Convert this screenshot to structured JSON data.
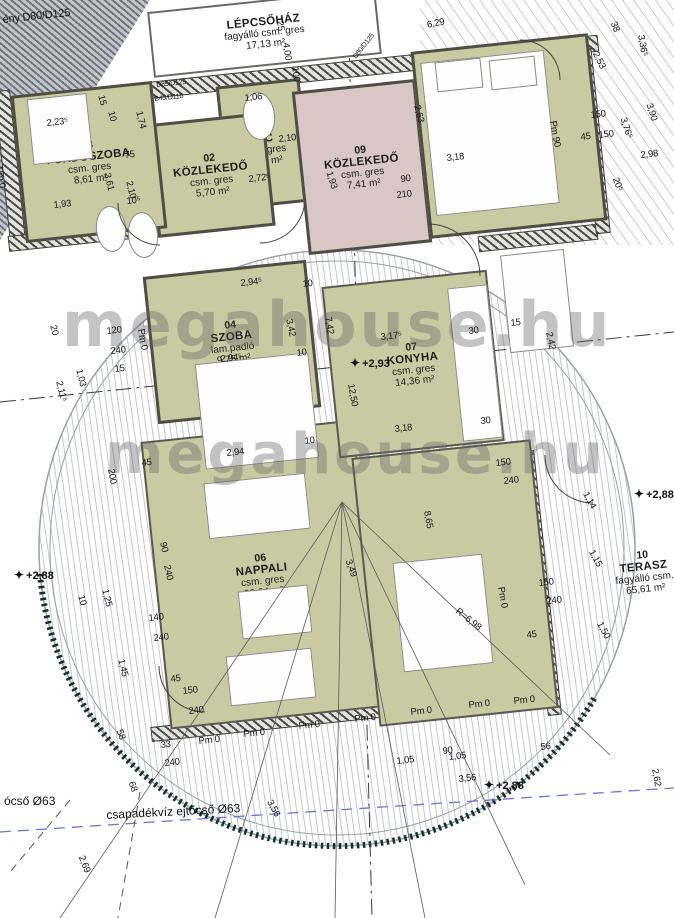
{
  "drawing": {
    "kind": "floor-plan"
  },
  "watermark": {
    "text": "megahouse.hu"
  },
  "rooms": [
    {
      "id": "lepcsohaz",
      "number": "",
      "name": "LÉPCSŐHÁZ",
      "material": "fagyálló csm. gres",
      "area": "17,13 m²",
      "x": 150,
      "y": 0,
      "w": 225,
      "h": 62,
      "fill": "#ffffff",
      "rot": -6,
      "wall": "thin"
    },
    {
      "id": "wc",
      "number": "01",
      "name": "WC",
      "material": "csm. gres",
      "area": "1,75 m²",
      "x": 222,
      "y": 82,
      "w": 78,
      "h": 118,
      "fill": "#c9caa2",
      "rot": -6,
      "wall": "solid"
    },
    {
      "id": "kozlekedo-02",
      "number": "02",
      "name": "KÖZLEKEDŐ",
      "material": "csm. gres",
      "area": "5,70 m²",
      "x": 152,
      "y": 118,
      "w": 112,
      "h": 108,
      "fill": "#c9caa2",
      "rot": -6,
      "wall": "solid"
    },
    {
      "id": "furdoszoba-03",
      "number": "03",
      "name": "FÜRDŐSZOBA",
      "material": "csm. gres",
      "area": "8,61 m²",
      "x": 18,
      "y": 88,
      "w": 136,
      "h": 142,
      "fill": "#c9caa2",
      "rot": -6,
      "wall": "solid"
    },
    {
      "id": "szoba-04",
      "number": "04",
      "name": "SZOBA",
      "material": "lam.padló",
      "area": "9,75 m²",
      "x": 150,
      "y": 268,
      "w": 158,
      "h": 142,
      "fill": "#c9caa2",
      "rot": -6,
      "wall": "solid"
    },
    {
      "id": "kozlekedo-09",
      "number": "09",
      "name": "KÖZLEKEDŐ",
      "material": "csm. gres",
      "area": "7,41 m²",
      "x": 300,
      "y": 85,
      "w": 118,
      "h": 158,
      "fill": "#d8c7c5",
      "rot": -6,
      "wall": "solid"
    },
    {
      "id": "nappali-06",
      "number": "06",
      "name": "NAPPALI",
      "material": "csm. gres",
      "area": "20,24 m²",
      "x": 155,
      "y": 430,
      "w": 210,
      "h": 285,
      "fill": "#c9caa2",
      "rot": -6,
      "wall": "open"
    },
    {
      "id": "konyha-07",
      "number": "07",
      "name": "KONYHA",
      "material": "csm. gres",
      "area": "14,36 m²",
      "x": 330,
      "y": 278,
      "w": 162,
      "h": 168,
      "fill": "#c9caa2",
      "rot": -6,
      "wall": "open"
    },
    {
      "id": "szoba-08",
      "number": "08",
      "name": "SZOBA",
      "material": "lam.padló",
      "area": "12,19 m²",
      "x": 420,
      "y": 42,
      "w": 172,
      "h": 182,
      "fill": "#c9caa2",
      "rot": -6,
      "wall": "solid"
    },
    {
      "id": "etkezo-09",
      "number": "09",
      "name": "ÉTKEZŐ",
      "material": "csm. gres",
      "area": "16,91 m²",
      "x": 365,
      "y": 448,
      "w": 176,
      "h": 266,
      "fill": "#c9caa2",
      "rot": -6,
      "wall": "open"
    },
    {
      "id": "terasz-10",
      "number": "10",
      "name": "TERASZ",
      "material": "fagyálló csm.",
      "area": "65,61 m²",
      "x": 596,
      "y": 532,
      "w": 96,
      "h": 80,
      "fill": "transparent",
      "rot": -6,
      "wall": "none"
    }
  ],
  "levels": [
    {
      "text": "+2,93",
      "x": 350,
      "y": 356
    },
    {
      "text": "+2,88",
      "x": 14,
      "y": 568
    },
    {
      "text": "+2,88",
      "x": 484,
      "y": 778
    },
    {
      "text": "+2,88",
      "x": 634,
      "y": 487
    }
  ],
  "notes": [
    {
      "text": "ócső Ø63",
      "x": 4,
      "y": 794,
      "r": 0
    },
    {
      "text": "csapadékvíz ejtőcső Ø63",
      "x": 106,
      "y": 808,
      "r": -3
    }
  ],
  "dims": [
    {
      "t": "ény D80/D125",
      "x": 2,
      "y": 14,
      "r": -6,
      "s": 11
    },
    {
      "t": "6,29",
      "x": 426,
      "y": 20,
      "r": -12
    },
    {
      "t": "25",
      "x": 285,
      "y": 20,
      "r": 82
    },
    {
      "t": "4,00",
      "x": 291,
      "y": 42,
      "r": 82
    },
    {
      "t": "100",
      "x": 300,
      "y": 66,
      "r": 82
    },
    {
      "t": "D85/D125",
      "x": 156,
      "y": 82,
      "r": -6,
      "s": 7
    },
    {
      "t": "B45/D110",
      "x": 154,
      "y": 96,
      "r": -6,
      "s": 7
    },
    {
      "t": "D80/D125",
      "x": 352,
      "y": 56,
      "r": -52,
      "s": 7
    },
    {
      "t": "15",
      "x": 106,
      "y": 94,
      "r": 76
    },
    {
      "t": "10",
      "x": 116,
      "y": 110,
      "r": 76
    },
    {
      "t": "2,23⁵",
      "x": 46,
      "y": 118,
      "r": -6
    },
    {
      "t": "1,74",
      "x": 144,
      "y": 110,
      "r": 76
    },
    {
      "t": "75",
      "x": 124,
      "y": 150,
      "r": -6
    },
    {
      "t": "3,61",
      "x": 112,
      "y": 172,
      "r": 76
    },
    {
      "t": "2,10",
      "x": 134,
      "y": 180,
      "r": 76
    },
    {
      "t": "1,93",
      "x": 53,
      "y": 200,
      "r": -6
    },
    {
      "t": "10⁵",
      "x": 126,
      "y": 196,
      "r": -6
    },
    {
      "t": "Pm 0",
      "x": 4,
      "y": 166,
      "r": 80
    },
    {
      "t": "2,72⁵",
      "x": 248,
      "y": 174,
      "r": -6
    },
    {
      "t": "2,10",
      "x": 278,
      "y": 134,
      "r": -6
    },
    {
      "t": "1,06",
      "x": 244,
      "y": 93,
      "r": -6
    },
    {
      "t": "1,93",
      "x": 334,
      "y": 170,
      "r": 72
    },
    {
      "t": "2,63",
      "x": 422,
      "y": 104,
      "r": 76
    },
    {
      "t": "3,18",
      "x": 446,
      "y": 153,
      "r": -6
    },
    {
      "t": "90",
      "x": 400,
      "y": 174,
      "r": -6
    },
    {
      "t": "210",
      "x": 396,
      "y": 190,
      "r": -6
    },
    {
      "t": "Pm 90",
      "x": 558,
      "y": 120,
      "r": 80
    },
    {
      "t": "150",
      "x": 590,
      "y": 110,
      "r": -6
    },
    {
      "t": "45",
      "x": 580,
      "y": 132,
      "r": -6
    },
    {
      "t": "150",
      "x": 598,
      "y": 130,
      "r": -6
    },
    {
      "t": "38",
      "x": 618,
      "y": 20,
      "r": 68
    },
    {
      "t": "2,53",
      "x": 600,
      "y": 50,
      "r": 64
    },
    {
      "t": "3,36⁵",
      "x": 646,
      "y": 34,
      "r": 80
    },
    {
      "t": "3,76⁵",
      "x": 628,
      "y": 116,
      "r": 72
    },
    {
      "t": "3,90",
      "x": 654,
      "y": 102,
      "r": 72
    },
    {
      "t": "2,98",
      "x": 640,
      "y": 150,
      "r": -6
    },
    {
      "t": "20⁵",
      "x": 620,
      "y": 176,
      "r": 68
    },
    {
      "t": "2,94⁵",
      "x": 240,
      "y": 278,
      "r": -6
    },
    {
      "t": "10",
      "x": 302,
      "y": 279,
      "r": -6
    },
    {
      "t": "3,42",
      "x": 294,
      "y": 318,
      "r": 78
    },
    {
      "t": "2,94⁵",
      "x": 220,
      "y": 354,
      "r": -6
    },
    {
      "t": "10",
      "x": 296,
      "y": 348,
      "r": -6
    },
    {
      "t": "120",
      "x": 106,
      "y": 326,
      "r": -6
    },
    {
      "t": "240",
      "x": 110,
      "y": 346,
      "r": -6
    },
    {
      "t": "15",
      "x": 114,
      "y": 364,
      "r": -6
    },
    {
      "t": "Pm 0",
      "x": 146,
      "y": 328,
      "r": 80
    },
    {
      "t": "20",
      "x": 58,
      "y": 324,
      "r": 76
    },
    {
      "t": "1,03",
      "x": 84,
      "y": 368,
      "r": 76
    },
    {
      "t": "2,11⁵",
      "x": 64,
      "y": 380,
      "r": 76
    },
    {
      "t": "7,42",
      "x": 333,
      "y": 316,
      "r": 80
    },
    {
      "t": "3,17⁵",
      "x": 380,
      "y": 332,
      "r": -6
    },
    {
      "t": "12,50",
      "x": 356,
      "y": 383,
      "r": 80
    },
    {
      "t": "30",
      "x": 468,
      "y": 326,
      "r": -6
    },
    {
      "t": "15",
      "x": 510,
      "y": 318,
      "r": -6
    },
    {
      "t": "2,42",
      "x": 554,
      "y": 331,
      "r": 78
    },
    {
      "t": "3,18",
      "x": 394,
      "y": 424,
      "r": -6
    },
    {
      "t": "30",
      "x": 480,
      "y": 416,
      "r": -6
    },
    {
      "t": "2,94",
      "x": 226,
      "y": 448,
      "r": -6
    },
    {
      "t": "10",
      "x": 304,
      "y": 436,
      "r": -6
    },
    {
      "t": "150",
      "x": 495,
      "y": 458,
      "r": -6
    },
    {
      "t": "240",
      "x": 503,
      "y": 476,
      "r": -6
    },
    {
      "t": "45",
      "x": 141,
      "y": 458,
      "r": -6
    },
    {
      "t": "200",
      "x": 116,
      "y": 468,
      "r": 80
    },
    {
      "t": "90",
      "x": 168,
      "y": 541,
      "r": 78
    },
    {
      "t": "240",
      "x": 172,
      "y": 564,
      "r": 78
    },
    {
      "t": "3,49",
      "x": 353,
      "y": 558,
      "r": 70
    },
    {
      "t": "8,65",
      "x": 432,
      "y": 510,
      "r": 80
    },
    {
      "t": "45",
      "x": 170,
      "y": 674,
      "r": -6
    },
    {
      "t": "150",
      "x": 182,
      "y": 686,
      "r": -6
    },
    {
      "t": "240",
      "x": 188,
      "y": 706,
      "r": -6
    },
    {
      "t": "Pm 0",
      "x": 198,
      "y": 736,
      "r": -6
    },
    {
      "t": "Pm 0",
      "x": 243,
      "y": 729,
      "r": -6
    },
    {
      "t": "Pm 0",
      "x": 298,
      "y": 721,
      "r": -6
    },
    {
      "t": "Pm 0",
      "x": 354,
      "y": 714,
      "r": -6
    },
    {
      "t": "Pm 0",
      "x": 410,
      "y": 707,
      "r": -6
    },
    {
      "t": "Pm 0",
      "x": 468,
      "y": 700,
      "r": -6
    },
    {
      "t": "Pm 0",
      "x": 513,
      "y": 696,
      "r": -6
    },
    {
      "t": "R=6,98",
      "x": 460,
      "y": 606,
      "r": 38
    },
    {
      "t": "Pm 0",
      "x": 506,
      "y": 586,
      "r": 80
    },
    {
      "t": "150",
      "x": 538,
      "y": 578,
      "r": -6
    },
    {
      "t": "240",
      "x": 546,
      "y": 596,
      "r": -6
    },
    {
      "t": "45",
      "x": 526,
      "y": 630,
      "r": -6
    },
    {
      "t": "1,14",
      "x": 590,
      "y": 490,
      "r": 62
    },
    {
      "t": "1,15",
      "x": 596,
      "y": 548,
      "r": 62
    },
    {
      "t": "1,50",
      "x": 604,
      "y": 620,
      "r": 62
    },
    {
      "t": "10",
      "x": 86,
      "y": 594,
      "r": 76
    },
    {
      "t": "1,25",
      "x": 110,
      "y": 588,
      "r": 76
    },
    {
      "t": "140",
      "x": 148,
      "y": 613,
      "r": -6
    },
    {
      "t": "240",
      "x": 153,
      "y": 633,
      "r": -6
    },
    {
      "t": "1,45",
      "x": 126,
      "y": 658,
      "r": 76
    },
    {
      "t": "33",
      "x": 160,
      "y": 740,
      "r": -6
    },
    {
      "t": "240",
      "x": 164,
      "y": 758,
      "r": -6
    },
    {
      "t": "58",
      "x": 124,
      "y": 728,
      "r": 70
    },
    {
      "t": "68",
      "x": 136,
      "y": 780,
      "r": 70
    },
    {
      "t": "3,56",
      "x": 274,
      "y": 798,
      "r": 62
    },
    {
      "t": "2,69",
      "x": 86,
      "y": 854,
      "r": 68
    },
    {
      "t": "1,05",
      "x": 396,
      "y": 756,
      "r": -6
    },
    {
      "t": "1,05",
      "x": 448,
      "y": 752,
      "r": -6
    },
    {
      "t": "3,56",
      "x": 458,
      "y": 774,
      "r": -6
    },
    {
      "t": "90",
      "x": 442,
      "y": 746,
      "r": -6
    },
    {
      "t": "56",
      "x": 540,
      "y": 742,
      "r": -6
    },
    {
      "t": "2,62",
      "x": 660,
      "y": 768,
      "r": 80
    }
  ],
  "walls": [
    {
      "x": 0,
      "y": 66,
      "w": 598,
      "h": 15,
      "r": -6
    },
    {
      "x": 2,
      "y": 90,
      "w": 14,
      "h": 150,
      "r": -6
    },
    {
      "x": 8,
      "y": 228,
      "w": 150,
      "h": 14,
      "r": -6
    },
    {
      "x": 478,
      "y": 230,
      "w": 118,
      "h": 14,
      "r": -6
    },
    {
      "x": 586,
      "y": 46,
      "w": 13,
      "h": 186,
      "r": -6
    },
    {
      "x": 534,
      "y": 450,
      "w": 12,
      "h": 264,
      "r": -6
    },
    {
      "x": 150,
      "y": 706,
      "w": 400,
      "h": 13,
      "r": -6
    }
  ],
  "furniture": [
    {
      "id": "shower",
      "x": 30,
      "y": 96,
      "w": 58,
      "h": 64,
      "shape": "rect"
    },
    {
      "id": "toilet-wc",
      "x": 243,
      "y": 92,
      "w": 30,
      "h": 46,
      "shape": "ellipse"
    },
    {
      "id": "toilet-bath",
      "x": 96,
      "y": 206,
      "w": 28,
      "h": 44,
      "shape": "ellipse"
    },
    {
      "id": "bidet-bath",
      "x": 128,
      "y": 212,
      "w": 28,
      "h": 44,
      "shape": "ellipse"
    },
    {
      "id": "bathtub",
      "x": 505,
      "y": 252,
      "w": 62,
      "h": 96,
      "shape": "rect"
    },
    {
      "id": "bed-szoba08",
      "x": 428,
      "y": 56,
      "w": 122,
      "h": 152,
      "shape": "rect"
    },
    {
      "id": "pillow-1",
      "x": 436,
      "y": 60,
      "w": 44,
      "h": 28,
      "shape": "rect"
    },
    {
      "id": "pillow-2",
      "x": 490,
      "y": 58,
      "w": 44,
      "h": 28,
      "shape": "rect"
    },
    {
      "id": "bed-szoba04",
      "x": 200,
      "y": 358,
      "w": 112,
      "h": 104,
      "shape": "rect"
    },
    {
      "id": "sofa-1",
      "x": 206,
      "y": 478,
      "w": 100,
      "h": 54,
      "shape": "rect"
    },
    {
      "id": "coffee-table",
      "x": 240,
      "y": 588,
      "w": 68,
      "h": 46,
      "shape": "rect"
    },
    {
      "id": "sofa-2",
      "x": 228,
      "y": 652,
      "w": 84,
      "h": 48,
      "shape": "rect"
    },
    {
      "id": "dining-table",
      "x": 398,
      "y": 558,
      "w": 88,
      "h": 108,
      "shape": "rect"
    },
    {
      "id": "kitchen-counter",
      "x": 455,
      "y": 286,
      "w": 38,
      "h": 152,
      "shape": "rect"
    }
  ]
}
